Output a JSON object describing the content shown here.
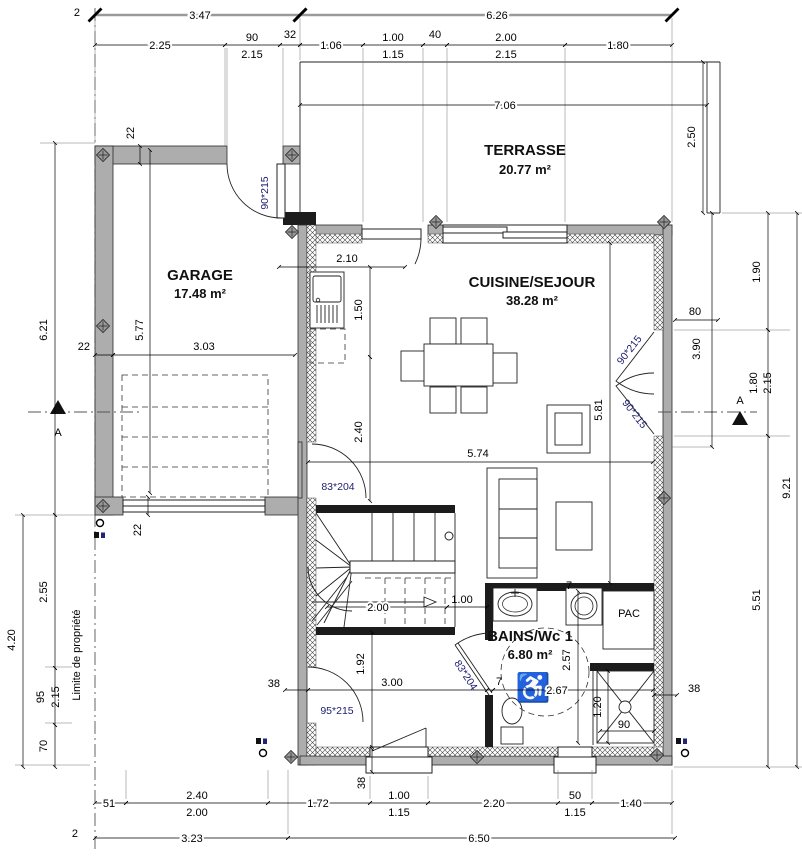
{
  "plan": {
    "rooms": {
      "terrasse": {
        "name": "TERRASSE",
        "area": "20.77 m²"
      },
      "garage": {
        "name": "GARAGE",
        "area": "17.48 m²"
      },
      "cuisine": {
        "name": "CUISINE/SEJOUR",
        "area": "38.28 m²"
      },
      "bains": {
        "name": "BAINS/Wc 1",
        "area": "6.80 m²"
      },
      "pac": {
        "name": "PAC"
      }
    },
    "doors": {
      "garage": "90*215",
      "french_top": "90*215",
      "french_bottom": "90*215",
      "hall": "83*204",
      "bath": "83*204",
      "entry": "95*215"
    },
    "labels": {
      "limite": "Limite de propriété",
      "section": "A"
    },
    "icons": {
      "wheelchair": "♿"
    },
    "dims": {
      "t0a": "3.47",
      "t0b": "6.26",
      "t1a": "2.25",
      "t1b": "90",
      "t1b2": "2.15",
      "t1c": "32",
      "t1d": "1.06",
      "t1e": "1.00",
      "t1e2": "1.15",
      "t1f": "40",
      "t1g": "2.00",
      "t1g2": "2.15",
      "t1h": "1.80",
      "t2": "7.06",
      "terr": "2.50",
      "r1a": "1.90",
      "r1b": "1.80",
      "r1b2": "2.15",
      "r1c": "5.51",
      "r2": "9.21",
      "r80": "80",
      "r390": "3.90",
      "r38": "38",
      "l621": "6.21",
      "l420": "4.20",
      "l255": "2.55",
      "l95": "95",
      "l215": "2.15",
      "l70": "70",
      "p2t": "2",
      "p2b": "2",
      "g22a": "22",
      "g22b": "22",
      "g22c": "22",
      "g577": "5.77",
      "g303": "3.03",
      "k210": "2.10",
      "k150": "1.50",
      "k240": "2.40",
      "k574": "5.74",
      "k581": "5.81",
      "s200": "2.00",
      "s100": "1.00",
      "h192": "1.92",
      "h300": "3.00",
      "h38": "38",
      "h7": "7",
      "b257": "2.57",
      "b267": "2.67",
      "b120": "1.20",
      "b90": "90",
      "b7": "7",
      "bw38": "38",
      "bo1a": "51",
      "bo1b": "2.40",
      "bo1b2": "2.00",
      "bo1c": "1.72",
      "bo1d": "1.00",
      "bo1d2": "1.15",
      "bo1e": "2.20",
      "bo1f": "50",
      "bo1f2": "1.15",
      "bo1g": "1.40",
      "bo2a": "3.23",
      "bo2b": "6.50"
    }
  }
}
